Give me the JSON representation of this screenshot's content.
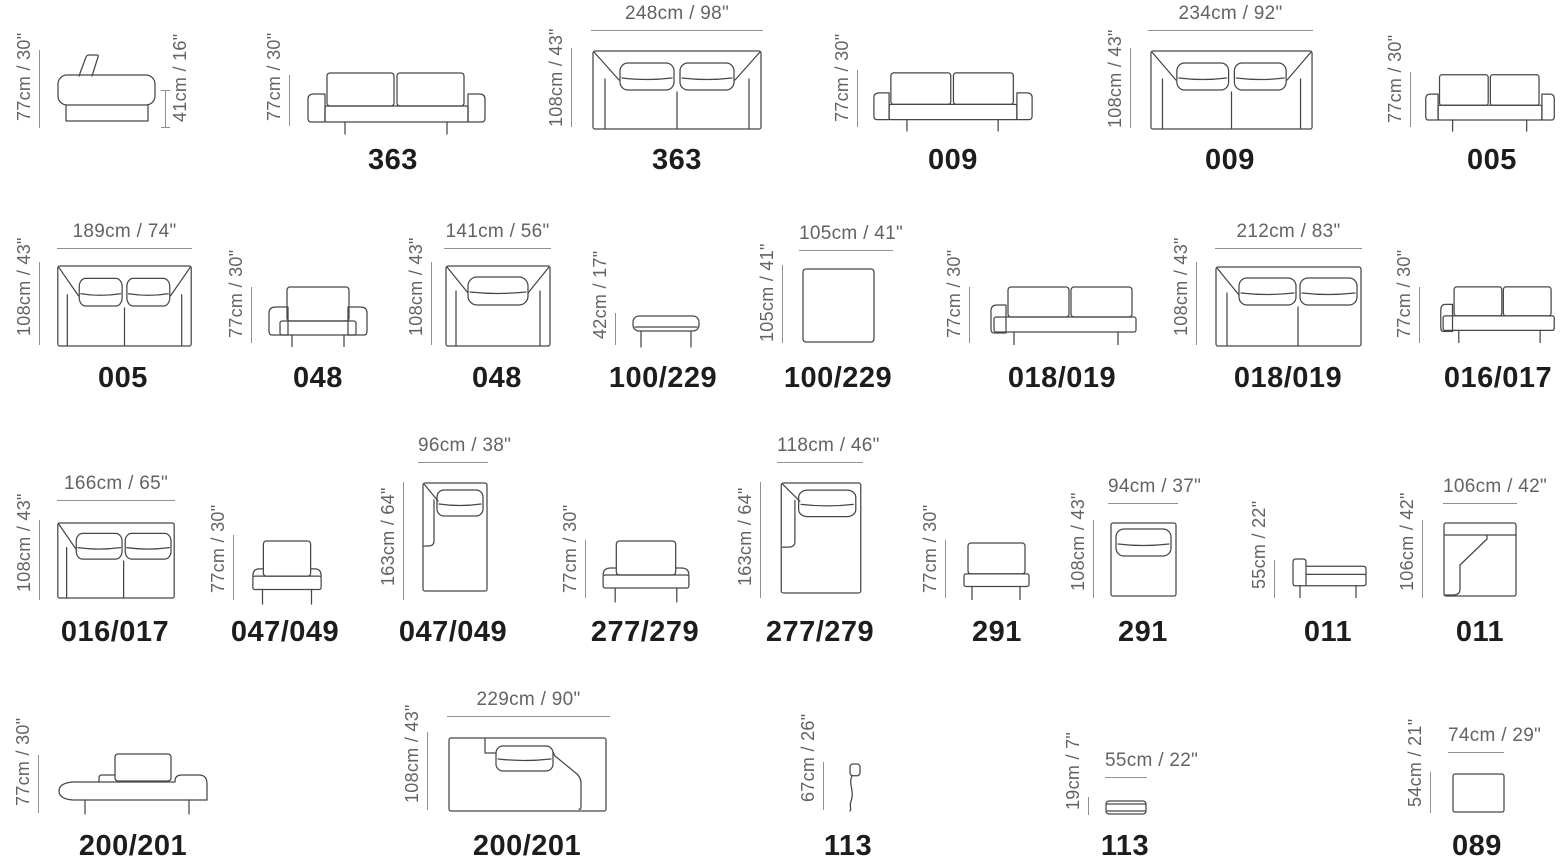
{
  "colors": {
    "background": "#ffffff",
    "drawing_line": "#474747",
    "dimension_text": "#636363",
    "dimension_line": "#8f8f8f",
    "model_text": "#1d1d1d"
  },
  "items": [
    {
      "name": "sofa-side-view",
      "model": null,
      "dim_top": null,
      "dim_left": "77cm / 30\"",
      "dim_right": "41cm / 16\""
    },
    {
      "name": "sofa-363-front",
      "model": "363",
      "dim_top": null,
      "dim_left": "77cm / 30\"",
      "dim_right": null
    },
    {
      "name": "sofa-363-top",
      "model": "363",
      "dim_top": "248cm / 98\"",
      "dim_left": "108cm / 43\"",
      "dim_right": null
    },
    {
      "name": "sofa-009-front",
      "model": "009",
      "dim_top": null,
      "dim_left": "77cm / 30\"",
      "dim_right": null
    },
    {
      "name": "sofa-009-top",
      "model": "009",
      "dim_top": "234cm / 92\"",
      "dim_left": "108cm / 43\"",
      "dim_right": null
    },
    {
      "name": "sofa-005-front",
      "model": "005",
      "dim_top": null,
      "dim_left": "77cm / 30\"",
      "dim_right": null
    },
    {
      "name": "sofa-005-top",
      "model": "005",
      "dim_top": "189cm / 74\"",
      "dim_left": "108cm / 43\"",
      "dim_right": null
    },
    {
      "name": "armchair-048-front",
      "model": "048",
      "dim_top": null,
      "dim_left": "77cm / 30\"",
      "dim_right": null
    },
    {
      "name": "armchair-048-top",
      "model": "048",
      "dim_top": "141cm / 56\"",
      "dim_left": "108cm / 43\"",
      "dim_right": null
    },
    {
      "name": "ottoman-100-229-front",
      "model": "100/229",
      "dim_top": null,
      "dim_left": "42cm / 17\"",
      "dim_right": null
    },
    {
      "name": "ottoman-100-229-top",
      "model": "100/229",
      "dim_top": "105cm / 41\"",
      "dim_left": "105cm / 41\"",
      "dim_right": null
    },
    {
      "name": "sofa-018-019-front",
      "model": "018/019",
      "dim_top": null,
      "dim_left": "77cm / 30\"",
      "dim_right": null
    },
    {
      "name": "sofa-018-019-top",
      "model": "018/019",
      "dim_top": "212cm / 83\"",
      "dim_left": "108cm / 43\"",
      "dim_right": null
    },
    {
      "name": "sofa-016-017-front",
      "model": "016/017",
      "dim_top": null,
      "dim_left": "77cm / 30\"",
      "dim_right": null
    },
    {
      "name": "sofa-016-017-top",
      "model": "016/017",
      "dim_top": "166cm / 65\"",
      "dim_left": "108cm / 43\"",
      "dim_right": null
    },
    {
      "name": "module-047-049-front",
      "model": "047/049",
      "dim_top": null,
      "dim_left": "77cm / 30\"",
      "dim_right": null
    },
    {
      "name": "module-047-049-top",
      "model": "047/049",
      "dim_top": "96cm / 38\"",
      "dim_left": "163cm / 64\"",
      "dim_right": null
    },
    {
      "name": "module-277-279-front",
      "model": "277/279",
      "dim_top": null,
      "dim_left": "77cm / 30\"",
      "dim_right": null
    },
    {
      "name": "module-277-279-top",
      "model": "277/279",
      "dim_top": "118cm / 46\"",
      "dim_left": "163cm / 64\"",
      "dim_right": null
    },
    {
      "name": "module-291-front",
      "model": "291",
      "dim_top": null,
      "dim_left": "77cm / 30\"",
      "dim_right": null
    },
    {
      "name": "module-291-top",
      "model": "291",
      "dim_top": "94cm / 37\"",
      "dim_left": "108cm / 43\"",
      "dim_right": null
    },
    {
      "name": "module-011-front",
      "model": "011",
      "dim_top": null,
      "dim_left": "55cm / 22\"",
      "dim_right": null
    },
    {
      "name": "module-011-top",
      "model": "011",
      "dim_top": "106cm / 42\"",
      "dim_left": "106cm / 42\"",
      "dim_right": null
    },
    {
      "name": "daybed-200-201-front",
      "model": "200/201",
      "dim_top": null,
      "dim_left": "77cm / 30\"",
      "dim_right": null
    },
    {
      "name": "daybed-200-201-top",
      "model": "200/201",
      "dim_top": "229cm / 90\"",
      "dim_left": "108cm / 43\"",
      "dim_right": null
    },
    {
      "name": "cushion-113-side",
      "model": "113",
      "dim_top": null,
      "dim_left": "67cm / 26\"",
      "dim_right": null
    },
    {
      "name": "cushion-113-front",
      "model": "113",
      "dim_top": "55cm / 22\"",
      "dim_left": "19cm / 7\"",
      "dim_right": null
    },
    {
      "name": "pouf-089-top",
      "model": "089",
      "dim_top": "74cm / 29\"",
      "dim_left": "54cm / 21\"",
      "dim_right": null
    }
  ]
}
